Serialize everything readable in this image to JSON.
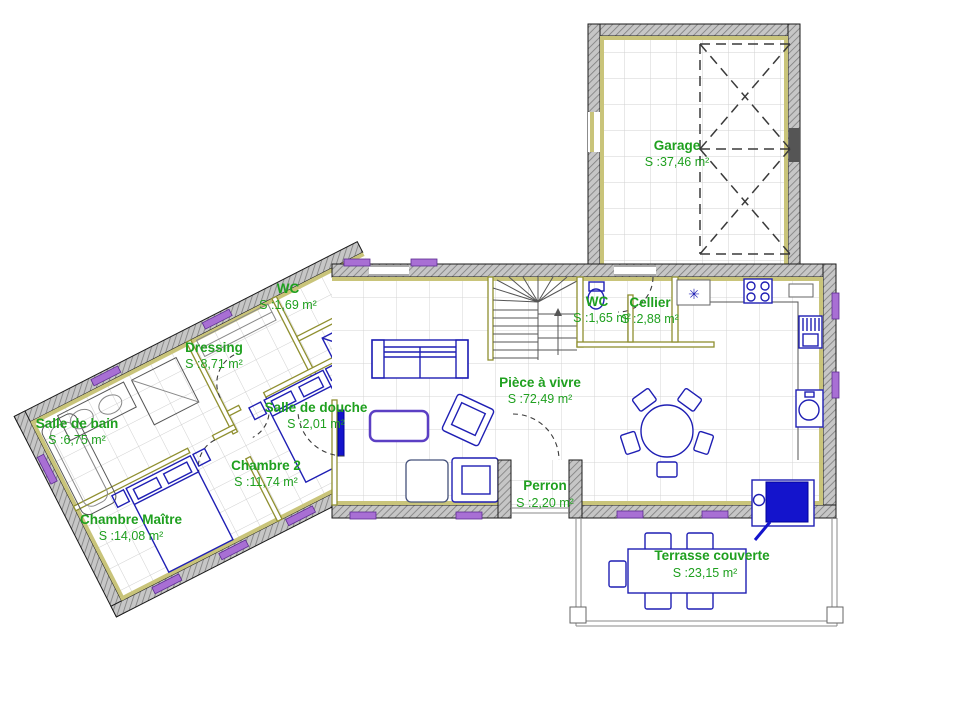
{
  "colors": {
    "label_green": "#1fa01f",
    "furniture_blue": "#1f1fb4",
    "window_purple": "#a86fd4",
    "exterior_wall_gray": "#c6c6c6",
    "partition_olive": "#8f8f2f",
    "accent_fill_blue": "#1414cc"
  },
  "symbols": {
    "appliance_star": "✳"
  },
  "rooms": [
    {
      "id": "garage",
      "name": "Garage",
      "area": "S :37,46 m²"
    },
    {
      "id": "wc-main",
      "name": "WC",
      "area": "S :1,65 m²"
    },
    {
      "id": "cellier",
      "name": "Cellier",
      "area": "S :2,88 m²"
    },
    {
      "id": "wc-wing",
      "name": "WC",
      "area": "S :1,69 m²"
    },
    {
      "id": "dressing",
      "name": "Dressing",
      "area": "S :8,71 m²"
    },
    {
      "id": "salle-de-bain",
      "name": "Salle de bain",
      "area": "S :6,75 m²"
    },
    {
      "id": "salle-de-douche",
      "name": "Salle de douche",
      "area": "S :2,01 m²"
    },
    {
      "id": "chambre-2",
      "name": "Chambre 2",
      "area": "S :11,74 m²"
    },
    {
      "id": "chambre-maitre",
      "name": "Chambre Maître",
      "area": "S :14,08 m²"
    },
    {
      "id": "piece-a-vivre",
      "name": "Pièce à vivre",
      "area": "S :72,49 m²"
    },
    {
      "id": "perron",
      "name": "Perron",
      "area": "S :2,20 m²"
    },
    {
      "id": "terrasse",
      "name": "Terrasse couverte",
      "area": "S :23,15 m²"
    }
  ]
}
